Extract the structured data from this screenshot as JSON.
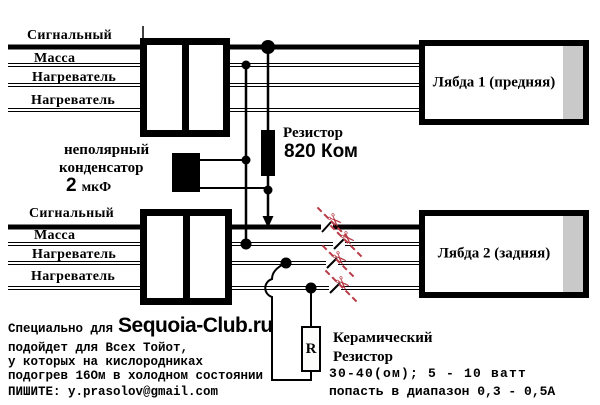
{
  "colors": {
    "cut_mark": "#b73a44",
    "connector_gray": "#c9c9c9"
  },
  "diagram": {
    "upper_harness": {
      "wire_labels": [
        "Сигнальный",
        "Масса",
        "Нагреватель",
        "Нагреватель"
      ]
    },
    "lower_harness": {
      "wire_labels": [
        "Сигнальный",
        "Масса",
        "Нагреватель",
        "Нагреватель"
      ]
    },
    "lambda1_label": "Лябда 1 (предняя)",
    "lambda2_label": "Лябда 2 (задняя)",
    "resistor_820": {
      "name": "Резистор",
      "value": "820 Ком"
    },
    "capacitor": {
      "line1": "неполярный",
      "line2": "конденсатор",
      "value": "2",
      "unit": "мкФ"
    },
    "ceramic_resistor": {
      "symbol": "R",
      "line1": "Керамический",
      "line2": "Резистор",
      "line3": "30-40(ом); 5 - 10 ватт",
      "line4": "попасть в диапазон 0,3 - 0,5А"
    },
    "scissors_icon": "✂"
  },
  "footer": {
    "line1_prefix": "Специально для",
    "site": "Sequoia-Club.ru",
    "line2": "подойдет для Всех Тойот,",
    "line3": "у которых на кислородниках",
    "line4": "подогрев 16Ом в холодном состоянии",
    "line5": "ПИШИТЕ: y.prasolov@gmail.com"
  }
}
